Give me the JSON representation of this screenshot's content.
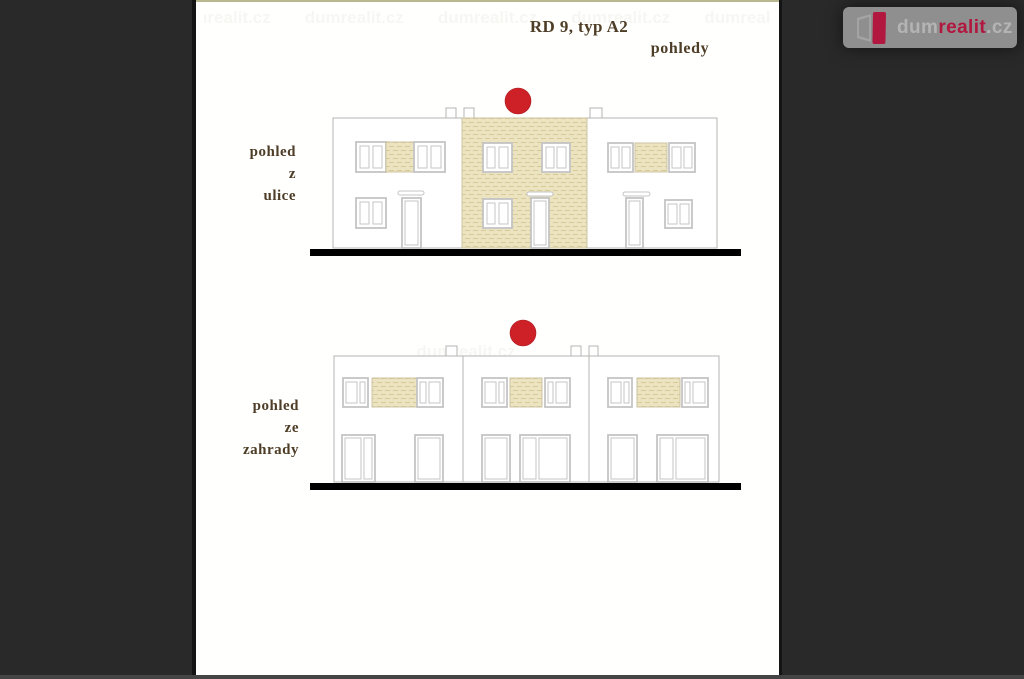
{
  "header": {
    "title": "RD 9, typ A2",
    "subtitle": "pohledy"
  },
  "views": [
    {
      "name": "street",
      "label_lines": [
        "pohled",
        "z",
        "ulice"
      ]
    },
    {
      "name": "garden",
      "label_lines": [
        "pohled",
        "ze",
        "zahrady"
      ]
    }
  ],
  "logo": {
    "part1": "dum",
    "part2": "realit",
    "part3": ".cz"
  },
  "watermark": {
    "text": "dumrealit.cz"
  },
  "colors": {
    "bg": "#292929",
    "bg_edge": "#454545",
    "paper": "#fffffe",
    "paper_edge": "#141414",
    "frame_top": "#b8b890",
    "ink": "#4e3d27",
    "line": "#b4b4b4",
    "frame": "#c4c4c4",
    "beige": "#ece4c1",
    "beige_dash": "#d7ca97",
    "marker_red": "#ce2127",
    "ground": "#000000",
    "logo_panel": "#8f8f8f",
    "logo_gray": "#b4b4b4",
    "logo_red": "#b2173f",
    "watermark_ink": "#8a8a66"
  }
}
